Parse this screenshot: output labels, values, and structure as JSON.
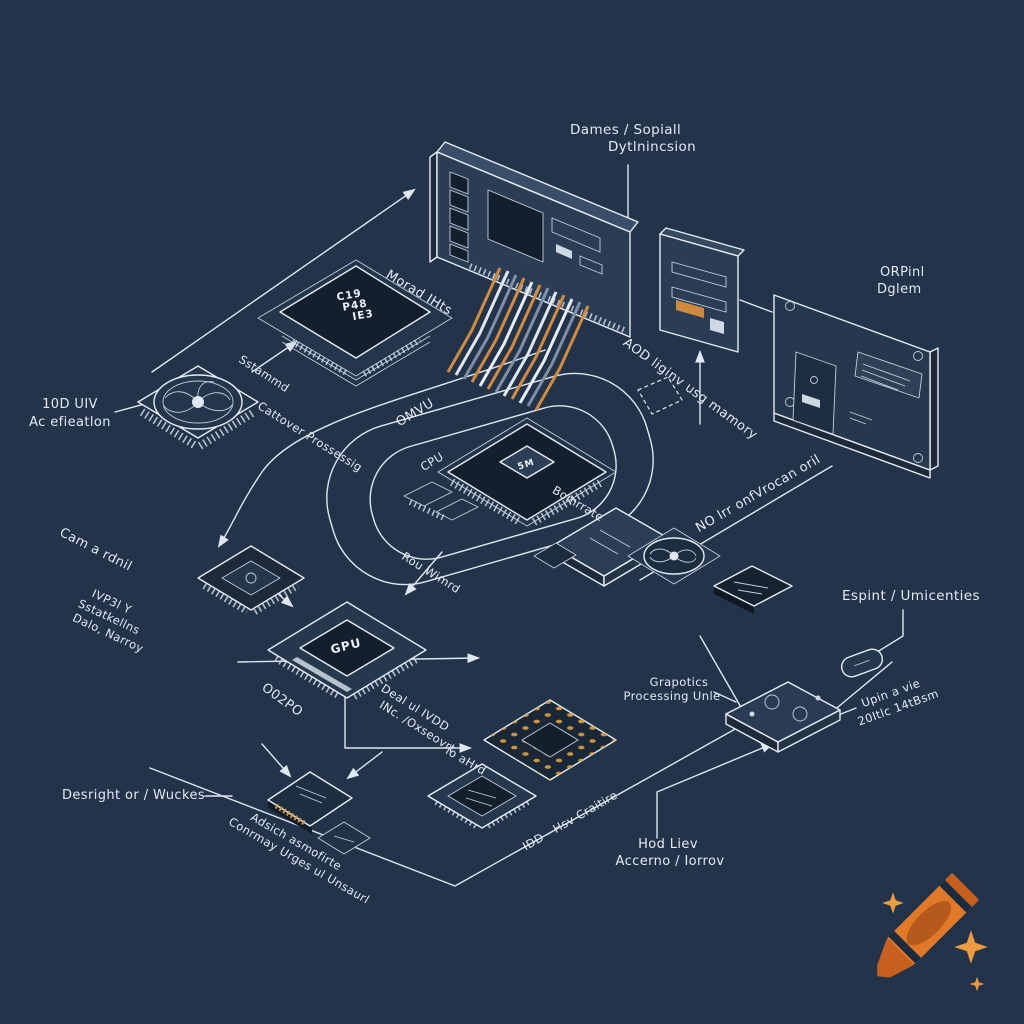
{
  "colors": {
    "background": "#22334a",
    "line": "#dfe7f0",
    "label_text": "#e3eaf2",
    "component_face": "#2b3d55",
    "component_dark": "#141f2d",
    "ribbon_orange": "#d18a3e",
    "pad_gold": "#d49a3f",
    "crayon_body": "#e07a28",
    "crayon_dark": "#c8601d",
    "crayon_label": "#b5591c",
    "sparkle": "#ec9b40"
  },
  "labels": {
    "dames_l1": "Dames / Sopiall",
    "dames_l2": "Dytlnincsion",
    "orpinl_l1": "ORPinl",
    "orpinl_l2": "Dglem",
    "tenduv_l1": "10D UIV",
    "tenduv_l2": "Ac efieatlon",
    "morad": "Morad IHts",
    "sstammd": "Sstammd",
    "cattover": "Cattover Prossessig",
    "omvu": "OMVU",
    "cpu": "CPU",
    "bomrrate": "Bomrrate",
    "aod": "AOD liginv usg mamory",
    "no_lrr": "NO lrr onfVrocan oril",
    "cam": "Cam a rdnil",
    "ivp3l_l1": "IVP3l Y",
    "ivp3l_l2": "Sstatkellns",
    "ivp3l_l3": "Dalo, Narroy",
    "rou": "Rou Wimrd",
    "espint": "Espint / Umicenties",
    "grapotics_l1": "Grapotics",
    "grapotics_l2": "Processing Unle",
    "upin_l1": "Upin a vie",
    "upin_l2": "20Itlc 14tBsm",
    "o02po": "O02PO",
    "deal_l1": "Deal ul IVDD",
    "deal_l2": "INc. /Oxseovrt",
    "desright": "Desright or / Wuckes",
    "adsich_l1": "Adsich asmofirte",
    "adsich_l2": "Conrmay Urges ul Unsaurl",
    "idd": "IDD - Hsv Craitire",
    "hod_l1": "Hod Liev",
    "hod_l2": "Accerno / Iorrov",
    "lo_ahrd": "lo aHrd"
  },
  "chip_text": {
    "c19_l1": "C19",
    "c19_l2": "P48",
    "c19_l3": "IE3",
    "cpu_die": "5M",
    "gpu": "GPU"
  }
}
